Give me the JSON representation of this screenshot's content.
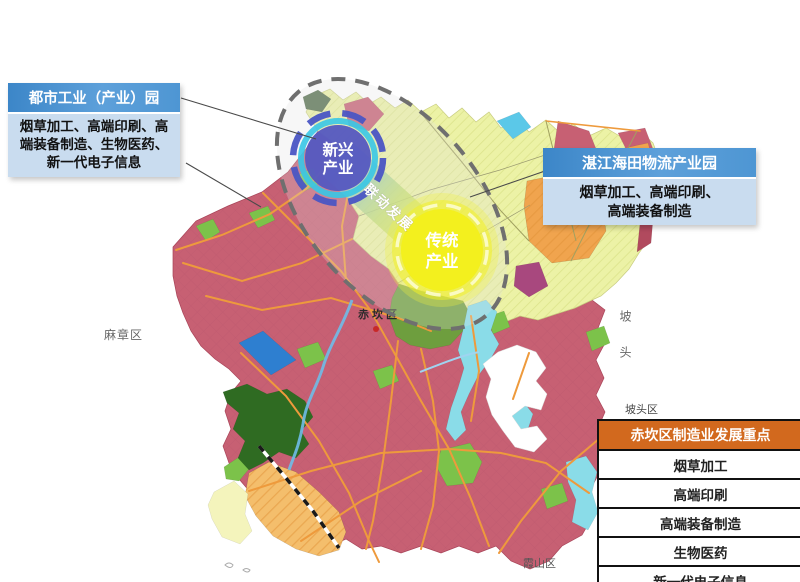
{
  "palette": {
    "callout_header_bg": "#4E96D3",
    "callout_body_bg": "#C9DCEF",
    "table_header_bg": "#D2691E",
    "map_rose": "#C76073",
    "map_yellow_green": "#ECF2A6",
    "map_orange": "#F0A44E",
    "map_green": "#7CC24A",
    "map_dark_green": "#2F6B22",
    "map_water_blue": "#2E7FD0",
    "map_cyan": "#8ADCE8",
    "road_orange": "#EE9A3C",
    "emerging_bubble_fill": "#5659BF",
    "emerging_bubble_ring": "#38C6E6",
    "traditional_bubble_fill": "#F3F01E",
    "focus_ellipse_stroke": "#6F6F6F"
  },
  "callout_urban": {
    "title": "都市工业（产业）园",
    "body": "烟草加工、高端印刷、高\n端装备制造、生物医药、\n新一代电子信息"
  },
  "callout_logistics": {
    "title": "湛江海田物流产业园",
    "body": "烟草加工、高端印刷、\n高端装备制造"
  },
  "bubbles": {
    "emerging": {
      "lines": [
        "新兴",
        "产业"
      ]
    },
    "traditional": {
      "lines": [
        "传统",
        "产业"
      ]
    },
    "link_label": "联动发展"
  },
  "focus_table": {
    "title": "赤坎区制造业发展重点",
    "rows": [
      "烟草加工",
      "高端印刷",
      "高端装备制造",
      "生物医药",
      "新一代电子信息"
    ]
  },
  "map_labels": {
    "mazhang": "麻章区",
    "potou_side": "坡头",
    "potou_district": "坡头区",
    "xiashan": "霞山区",
    "chikan": "赤坎区"
  }
}
